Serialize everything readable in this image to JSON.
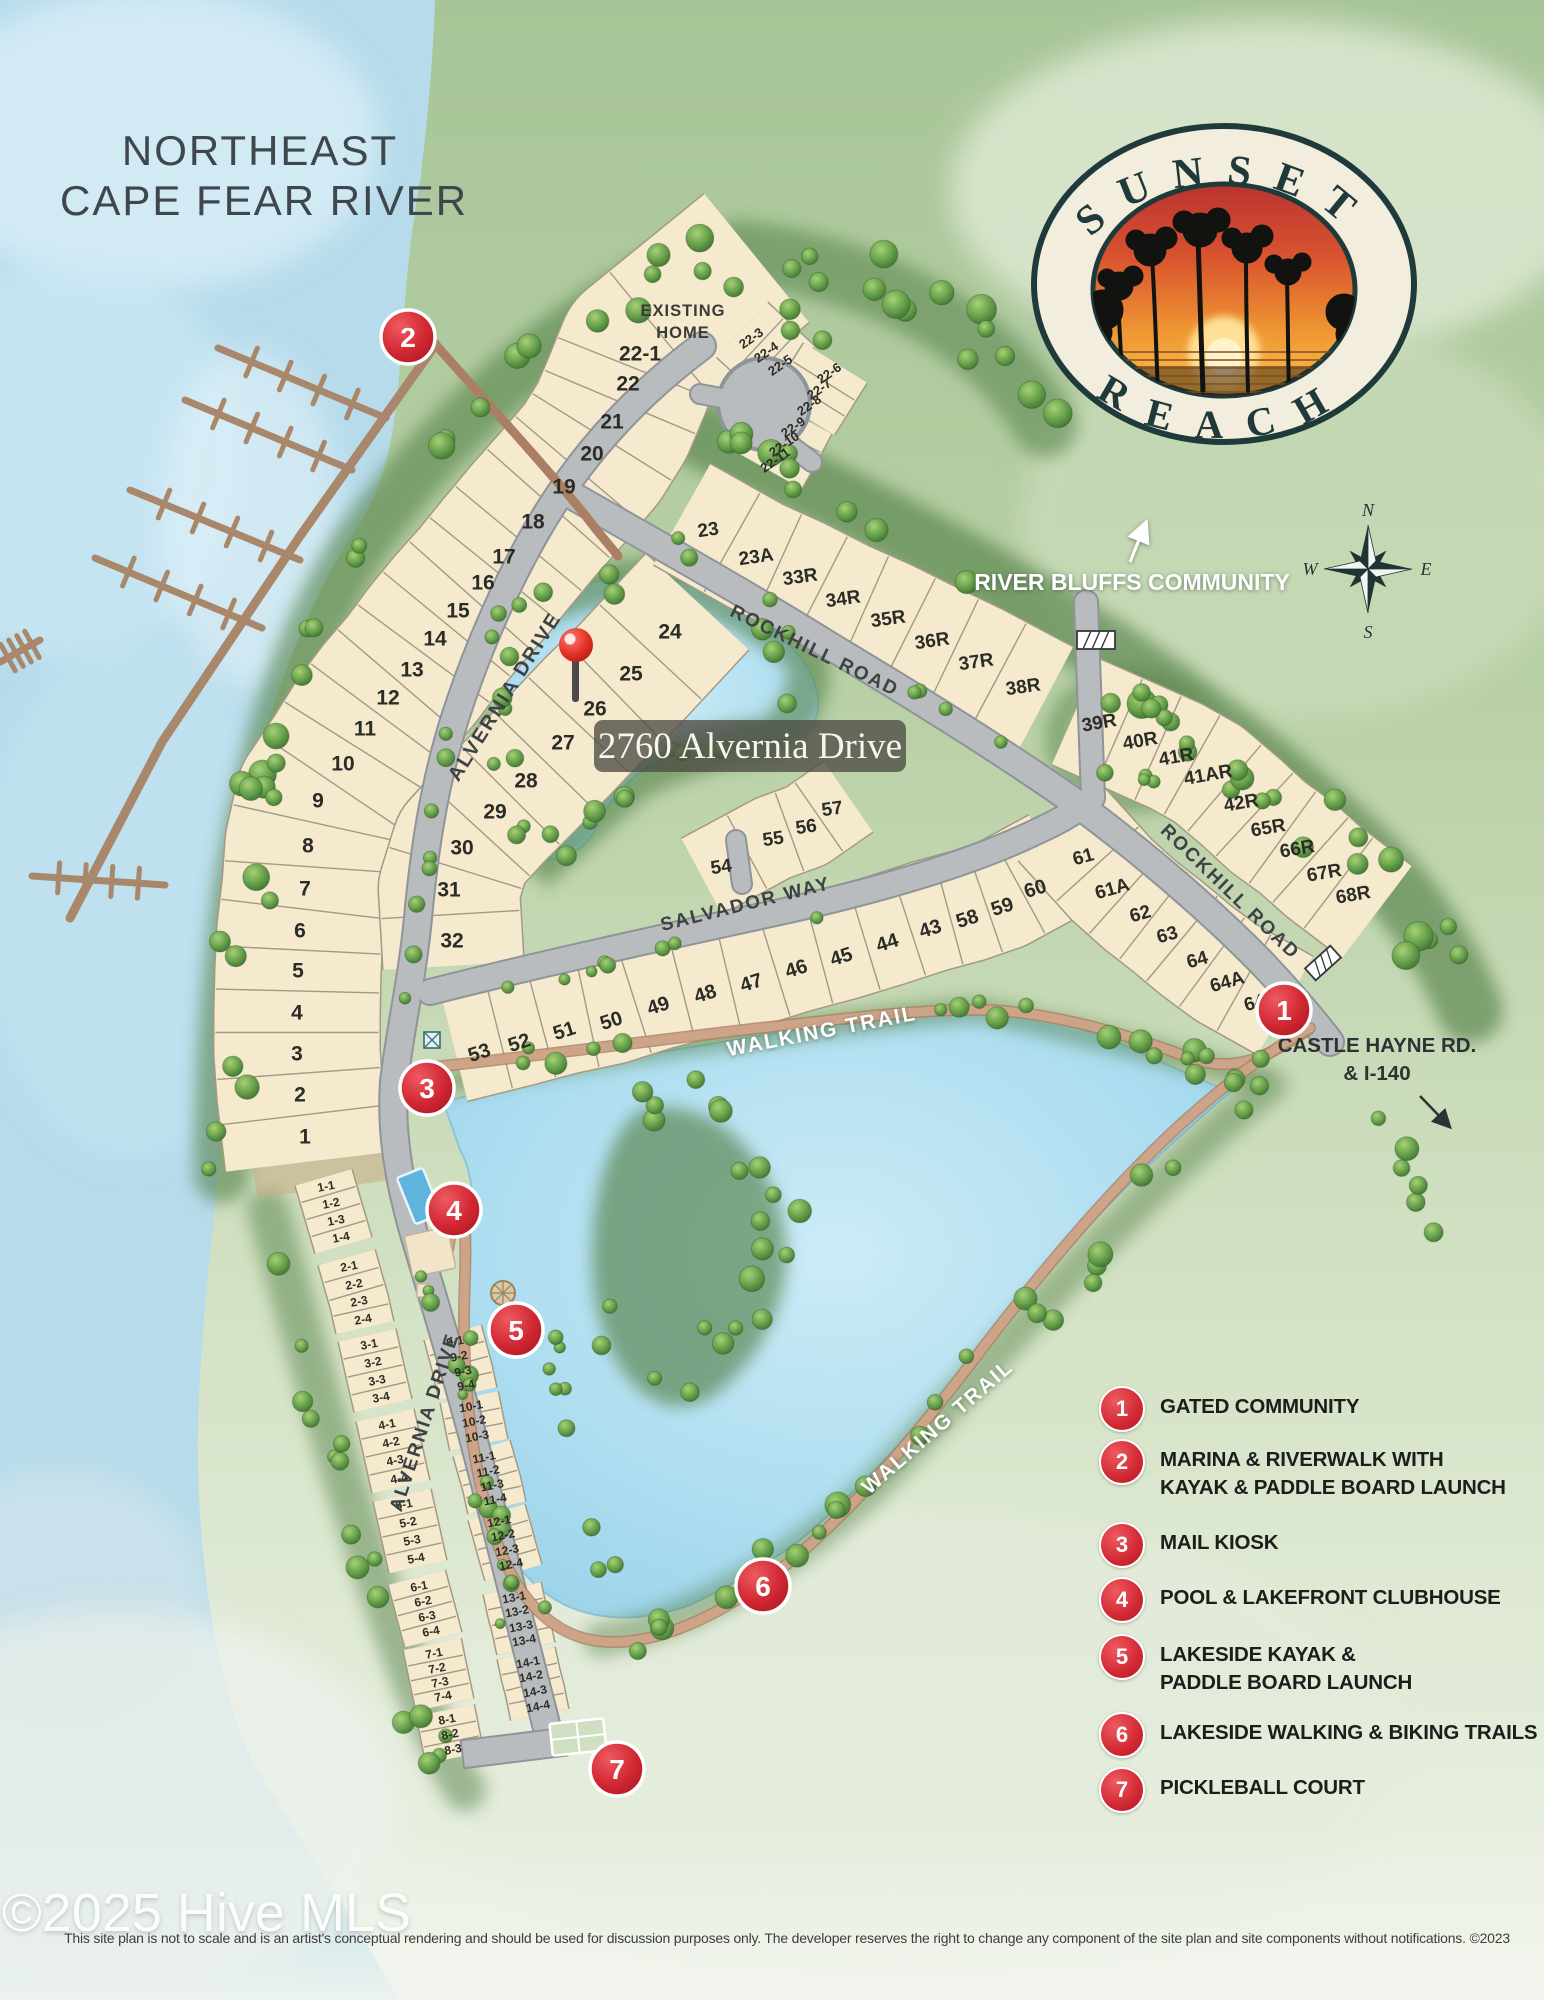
{
  "title": {
    "line1": "NORTHEAST",
    "line2": "CAPE FEAR RIVER"
  },
  "logo": {
    "top": "SUNSET",
    "bottom": "REACH"
  },
  "compass": {
    "n": "N",
    "e": "E",
    "s": "S",
    "w": "W"
  },
  "ann": {
    "river_bluffs": "RIVER BLUFFS COMMUNITY",
    "castle1": "CASTLE HAYNE RD.",
    "castle2": "& I-140",
    "existing1": "EXISTING",
    "existing2": "HOME",
    "callout": "2760 Alvernia Drive"
  },
  "footer": {
    "watermark": "©2025 Hive MLS",
    "disclaimer": "This site plan is not to scale and is an artist's conceptual rendering and should be used for discussion purposes only. The developer reserves the right to change any component of the site plan and site components without notifications. ©2023"
  },
  "colors": {
    "accent_red": "#d02732",
    "lot_fill": "#f5e9ce",
    "road": "#b8bcbf",
    "water": "#b7dbeb",
    "trail": "#c79e80",
    "legend_text": "#1d1d1b"
  },
  "road_labels": [
    {
      "t": "ALVERNIA DRIVE",
      "x": 510,
      "y": 700,
      "r": -58,
      "s": 20,
      "c": "#3d4245",
      "sh": false
    },
    {
      "t": "ALVERNIA DRIVE",
      "x": 430,
      "y": 1424,
      "r": -72,
      "s": 19,
      "c": "#3d4245",
      "sh": false
    },
    {
      "t": "ROCKHILL ROAD",
      "x": 812,
      "y": 656,
      "r": 26,
      "s": 19,
      "c": "#3d4245",
      "sh": false
    },
    {
      "t": "ROCKHILL ROAD",
      "x": 1226,
      "y": 896,
      "r": 44,
      "s": 19,
      "c": "#3d4245",
      "sh": false
    },
    {
      "t": "SALVADOR WAY",
      "x": 747,
      "y": 910,
      "r": -14,
      "s": 19,
      "c": "#3d4245",
      "sh": false
    },
    {
      "t": "WALKING TRAIL",
      "x": 823,
      "y": 1038,
      "r": -11,
      "s": 21,
      "c": "#ffffff",
      "sh": true
    },
    {
      "t": "WALKING TRAIL",
      "x": 942,
      "y": 1432,
      "r": -41,
      "s": 21,
      "c": "#ffffff",
      "sh": true
    }
  ],
  "markers": [
    {
      "n": "1",
      "x": 1284,
      "y": 1010
    },
    {
      "n": "2",
      "x": 408,
      "y": 337
    },
    {
      "n": "3",
      "x": 427,
      "y": 1088
    },
    {
      "n": "4",
      "x": 454,
      "y": 1210
    },
    {
      "n": "5",
      "x": 516,
      "y": 1330
    },
    {
      "n": "6",
      "x": 763,
      "y": 1586
    },
    {
      "n": "7",
      "x": 617,
      "y": 1769
    }
  ],
  "pin": {
    "x": 576,
    "y": 645
  },
  "callout": {
    "x": 750,
    "y": 746,
    "w": 312,
    "h": 52
  },
  "legend": {
    "items": [
      {
        "num": "1",
        "y": 1407,
        "lines": [
          "GATED COMMUNITY"
        ]
      },
      {
        "num": "2",
        "y": 1460,
        "lines": [
          "MARINA & RIVERWALK WITH",
          "KAYAK & PADDLE BOARD LAUNCH"
        ]
      },
      {
        "num": "3",
        "y": 1543,
        "lines": [
          "MAIL KIOSK"
        ]
      },
      {
        "num": "4",
        "y": 1598,
        "lines": [
          "POOL & LAKEFRONT CLUBHOUSE"
        ]
      },
      {
        "num": "5",
        "y": 1655,
        "lines": [
          "LAKESIDE KAYAK &",
          "PADDLE BOARD LAUNCH"
        ]
      },
      {
        "num": "6",
        "y": 1733,
        "lines": [
          "LAKESIDE WALKING & BIKING TRAILS"
        ]
      },
      {
        "num": "7",
        "y": 1788,
        "lines": [
          "PICKLEBALL COURT"
        ]
      }
    ]
  },
  "bands": [
    {
      "w": 165,
      "fs": 21,
      "lr": 0,
      "e0": 26,
      "e1": 95,
      "cells": [
        {
          "t": "1",
          "x": 305,
          "y": 1136
        },
        {
          "t": "2",
          "x": 300,
          "y": 1094
        },
        {
          "t": "3",
          "x": 297,
          "y": 1053
        },
        {
          "t": "4",
          "x": 297,
          "y": 1012
        },
        {
          "t": "5",
          "x": 298,
          "y": 970
        },
        {
          "t": "6",
          "x": 300,
          "y": 930
        },
        {
          "t": "7",
          "x": 305,
          "y": 888
        },
        {
          "t": "8",
          "x": 308,
          "y": 845
        },
        {
          "t": "9",
          "x": 318,
          "y": 800
        },
        {
          "t": "10",
          "x": 343,
          "y": 763
        },
        {
          "t": "11",
          "x": 365,
          "y": 728
        },
        {
          "t": "12",
          "x": 388,
          "y": 697
        },
        {
          "t": "13",
          "x": 412,
          "y": 669
        },
        {
          "t": "14",
          "x": 435,
          "y": 638
        },
        {
          "t": "15",
          "x": 458,
          "y": 610
        },
        {
          "t": "16",
          "x": 483,
          "y": 582
        },
        {
          "t": "17",
          "x": 504,
          "y": 556
        },
        {
          "t": "18",
          "x": 533,
          "y": 521
        },
        {
          "t": "19",
          "x": 564,
          "y": 486
        },
        {
          "t": "20",
          "x": 592,
          "y": 453
        },
        {
          "t": "21",
          "x": 612,
          "y": 421
        },
        {
          "t": "22",
          "x": 628,
          "y": 383
        },
        {
          "t": "22-1",
          "x": 640,
          "y": 353
        },
        {
          "t": "",
          "x": 683,
          "y": 318
        }
      ]
    },
    {
      "w": 140,
      "fs": 21,
      "lr": 0,
      "e0": 40,
      "e1": 26,
      "cells": [
        {
          "t": "24",
          "x": 670,
          "y": 631
        },
        {
          "t": "25",
          "x": 631,
          "y": 673
        },
        {
          "t": "26",
          "x": 595,
          "y": 708
        },
        {
          "t": "27",
          "x": 563,
          "y": 742
        },
        {
          "t": "28",
          "x": 526,
          "y": 780
        },
        {
          "t": "29",
          "x": 495,
          "y": 811
        },
        {
          "t": "30",
          "x": 462,
          "y": 847
        },
        {
          "t": "31",
          "x": 449,
          "y": 889
        },
        {
          "t": "32",
          "x": 452,
          "y": 940
        }
      ]
    },
    {
      "w": 115,
      "fs": 19,
      "lr": -8,
      "e0": 30,
      "e1": 26,
      "cells": [
        {
          "t": "23",
          "x": 708,
          "y": 529
        },
        {
          "t": "23A",
          "x": 756,
          "y": 556
        },
        {
          "t": "33R",
          "x": 800,
          "y": 576
        },
        {
          "t": "34R",
          "x": 843,
          "y": 598
        },
        {
          "t": "35R",
          "x": 888,
          "y": 618
        },
        {
          "t": "36R",
          "x": 932,
          "y": 640
        },
        {
          "t": "37R",
          "x": 976,
          "y": 661
        },
        {
          "t": "38R",
          "x": 1023,
          "y": 686
        }
      ]
    },
    {
      "w": 115,
      "fs": 19,
      "lr": -10,
      "e0": 26,
      "e1": 30,
      "cells": [
        {
          "t": "39R",
          "x": 1099,
          "y": 722
        },
        {
          "t": "40R",
          "x": 1140,
          "y": 740
        },
        {
          "t": "41R",
          "x": 1176,
          "y": 756
        },
        {
          "t": "41AR",
          "x": 1208,
          "y": 774
        },
        {
          "t": "42R",
          "x": 1241,
          "y": 802
        },
        {
          "t": "65R",
          "x": 1268,
          "y": 827
        },
        {
          "t": "66R",
          "x": 1297,
          "y": 848
        },
        {
          "t": "67R",
          "x": 1324,
          "y": 872
        },
        {
          "t": "68R",
          "x": 1353,
          "y": 894
        }
      ]
    },
    {
      "w": 112,
      "fs": 20,
      "lr": -18,
      "dy": -12,
      "e0": 26,
      "e1": 24,
      "cells": [
        {
          "t": "53",
          "x": 479,
          "y": 1052
        },
        {
          "t": "52",
          "x": 519,
          "y": 1042
        },
        {
          "t": "51",
          "x": 564,
          "y": 1030
        },
        {
          "t": "50",
          "x": 611,
          "y": 1020
        },
        {
          "t": "49",
          "x": 658,
          "y": 1005
        },
        {
          "t": "48",
          "x": 705,
          "y": 993
        },
        {
          "t": "47",
          "x": 751,
          "y": 982
        },
        {
          "t": "46",
          "x": 796,
          "y": 968
        },
        {
          "t": "45",
          "x": 841,
          "y": 956
        },
        {
          "t": "44",
          "x": 887,
          "y": 942
        },
        {
          "t": "43",
          "x": 930,
          "y": 928
        },
        {
          "t": "58",
          "x": 967,
          "y": 918
        },
        {
          "t": "59",
          "x": 1002,
          "y": 906
        },
        {
          "t": "60",
          "x": 1035,
          "y": 888
        }
      ]
    },
    {
      "w": 112,
      "fs": 19,
      "lr": -16,
      "dy": -8,
      "e0": 34,
      "e1": 28,
      "cells": [
        {
          "t": "61",
          "x": 1083,
          "y": 856
        },
        {
          "t": "61A",
          "x": 1112,
          "y": 888
        },
        {
          "t": "62",
          "x": 1140,
          "y": 913
        },
        {
          "t": "63",
          "x": 1167,
          "y": 934
        },
        {
          "t": "64",
          "x": 1197,
          "y": 959
        },
        {
          "t": "64A",
          "x": 1227,
          "y": 981
        },
        {
          "t": "64B",
          "x": 1261,
          "y": 1000
        }
      ]
    },
    {
      "w": 85,
      "fs": 19,
      "lr": -8,
      "e0": 22,
      "e1": 20,
      "cells": [
        {
          "t": "54",
          "x": 721,
          "y": 866
        },
        {
          "t": "55",
          "x": 773,
          "y": 838
        },
        {
          "t": "56",
          "x": 806,
          "y": 826
        },
        {
          "t": "57",
          "x": 832,
          "y": 808
        }
      ]
    },
    {
      "w": 74,
      "fs": 13,
      "lr": -35,
      "e0": 12,
      "e1": 12,
      "cells": [
        {
          "t": "22-3",
          "x": 751,
          "y": 338
        },
        {
          "t": "22-4",
          "x": 766,
          "y": 352
        },
        {
          "t": "22-5",
          "x": 780,
          "y": 365
        }
      ]
    },
    {
      "w": 74,
      "fs": 13,
      "lr": -35,
      "e0": 12,
      "e1": 12,
      "cells": [
        {
          "t": "22-6",
          "x": 829,
          "y": 373
        },
        {
          "t": "22-7",
          "x": 819,
          "y": 389
        },
        {
          "t": "22-8",
          "x": 809,
          "y": 405
        }
      ]
    },
    {
      "w": 74,
      "fs": 13,
      "lr": -35,
      "e0": 12,
      "e1": 12,
      "cells": [
        {
          "t": "22-9",
          "x": 793,
          "y": 427
        },
        {
          "t": "22-10",
          "x": 784,
          "y": 444
        },
        {
          "t": "22-11",
          "x": 775,
          "y": 460
        }
      ]
    },
    {
      "w": 58,
      "fs": 12,
      "lr": -11,
      "e0": 9,
      "e1": 9,
      "cells": [
        {
          "t": "1-1",
          "x": 326,
          "y": 1186
        },
        {
          "t": "1-2",
          "x": 331,
          "y": 1203
        },
        {
          "t": "1-3",
          "x": 336,
          "y": 1220
        },
        {
          "t": "1-4",
          "x": 341,
          "y": 1237
        }
      ]
    },
    {
      "w": 58,
      "fs": 12,
      "lr": -11,
      "e0": 9,
      "e1": 9,
      "cells": [
        {
          "t": "2-1",
          "x": 349,
          "y": 1266
        },
        {
          "t": "2-2",
          "x": 354,
          "y": 1284
        },
        {
          "t": "2-3",
          "x": 359,
          "y": 1301
        },
        {
          "t": "2-4",
          "x": 363,
          "y": 1319
        }
      ]
    },
    {
      "w": 58,
      "fs": 12,
      "lr": -11,
      "e0": 9,
      "e1": 9,
      "cells": [
        {
          "t": "3-1",
          "x": 369,
          "y": 1344
        },
        {
          "t": "3-2",
          "x": 373,
          "y": 1362
        },
        {
          "t": "3-3",
          "x": 377,
          "y": 1380
        },
        {
          "t": "3-4",
          "x": 381,
          "y": 1397
        }
      ]
    },
    {
      "w": 58,
      "fs": 12,
      "lr": -11,
      "e0": 9,
      "e1": 9,
      "cells": [
        {
          "t": "4-1",
          "x": 387,
          "y": 1424
        },
        {
          "t": "4-2",
          "x": 391,
          "y": 1442
        },
        {
          "t": "4-3",
          "x": 395,
          "y": 1460
        },
        {
          "t": "4-4",
          "x": 399,
          "y": 1478
        }
      ]
    },
    {
      "w": 58,
      "fs": 12,
      "lr": -11,
      "e0": 9,
      "e1": 9,
      "cells": [
        {
          "t": "5-1",
          "x": 404,
          "y": 1504
        },
        {
          "t": "5-2",
          "x": 408,
          "y": 1522
        },
        {
          "t": "5-3",
          "x": 412,
          "y": 1540
        },
        {
          "t": "5-4",
          "x": 416,
          "y": 1558
        }
      ]
    },
    {
      "w": 58,
      "fs": 12,
      "lr": -11,
      "e0": 9,
      "e1": 9,
      "cells": [
        {
          "t": "6-1",
          "x": 419,
          "y": 1586
        },
        {
          "t": "6-2",
          "x": 423,
          "y": 1601
        },
        {
          "t": "6-3",
          "x": 427,
          "y": 1616
        },
        {
          "t": "6-4",
          "x": 431,
          "y": 1631
        }
      ]
    },
    {
      "w": 58,
      "fs": 12,
      "lr": -11,
      "e0": 9,
      "e1": 9,
      "cells": [
        {
          "t": "7-1",
          "x": 434,
          "y": 1653
        },
        {
          "t": "7-2",
          "x": 437,
          "y": 1668
        },
        {
          "t": "7-3",
          "x": 440,
          "y": 1682
        },
        {
          "t": "7-4",
          "x": 443,
          "y": 1696
        }
      ]
    },
    {
      "w": 58,
      "fs": 12,
      "lr": -11,
      "e0": 9,
      "e1": 9,
      "cells": [
        {
          "t": "8-1",
          "x": 447,
          "y": 1719
        },
        {
          "t": "8-2",
          "x": 450,
          "y": 1734
        },
        {
          "t": "8-3",
          "x": 453,
          "y": 1749
        }
      ]
    },
    {
      "w": 58,
      "fs": 12,
      "lr": -11,
      "e0": 9,
      "e1": 9,
      "cells": [
        {
          "t": "9-1",
          "x": 455,
          "y": 1341
        },
        {
          "t": "9-2",
          "x": 459,
          "y": 1356
        },
        {
          "t": "9-3",
          "x": 463,
          "y": 1371
        },
        {
          "t": "9-4",
          "x": 466,
          "y": 1385
        }
      ]
    },
    {
      "w": 58,
      "fs": 12,
      "lr": -11,
      "e0": 9,
      "e1": 9,
      "cells": [
        {
          "t": "10-1",
          "x": 471,
          "y": 1406
        },
        {
          "t": "10-2",
          "x": 474,
          "y": 1421
        },
        {
          "t": "10-3",
          "x": 477,
          "y": 1436
        }
      ]
    },
    {
      "w": 58,
      "fs": 12,
      "lr": -11,
      "e0": 9,
      "e1": 9,
      "cells": [
        {
          "t": "11-1",
          "x": 484,
          "y": 1457
        },
        {
          "t": "11-2",
          "x": 488,
          "y": 1471
        },
        {
          "t": "11-3",
          "x": 492,
          "y": 1485
        },
        {
          "t": "11-4",
          "x": 495,
          "y": 1499
        }
      ]
    },
    {
      "w": 58,
      "fs": 12,
      "lr": -11,
      "e0": 9,
      "e1": 9,
      "cells": [
        {
          "t": "12-1",
          "x": 499,
          "y": 1521
        },
        {
          "t": "12-2",
          "x": 503,
          "y": 1535
        },
        {
          "t": "12-3",
          "x": 507,
          "y": 1550
        },
        {
          "t": "12-4",
          "x": 511,
          "y": 1564
        }
      ]
    },
    {
      "w": 58,
      "fs": 12,
      "lr": -11,
      "e0": 9,
      "e1": 9,
      "cells": [
        {
          "t": "13-1",
          "x": 514,
          "y": 1597
        },
        {
          "t": "13-2",
          "x": 517,
          "y": 1611
        },
        {
          "t": "13-3",
          "x": 521,
          "y": 1626
        },
        {
          "t": "13-4",
          "x": 524,
          "y": 1640
        }
      ]
    },
    {
      "w": 58,
      "fs": 12,
      "lr": -11,
      "e0": 9,
      "e1": 9,
      "cells": [
        {
          "t": "14-1",
          "x": 528,
          "y": 1662
        },
        {
          "t": "14-2",
          "x": 531,
          "y": 1676
        },
        {
          "t": "14-3",
          "x": 535,
          "y": 1691
        },
        {
          "t": "14-4",
          "x": 538,
          "y": 1706
        }
      ]
    }
  ]
}
